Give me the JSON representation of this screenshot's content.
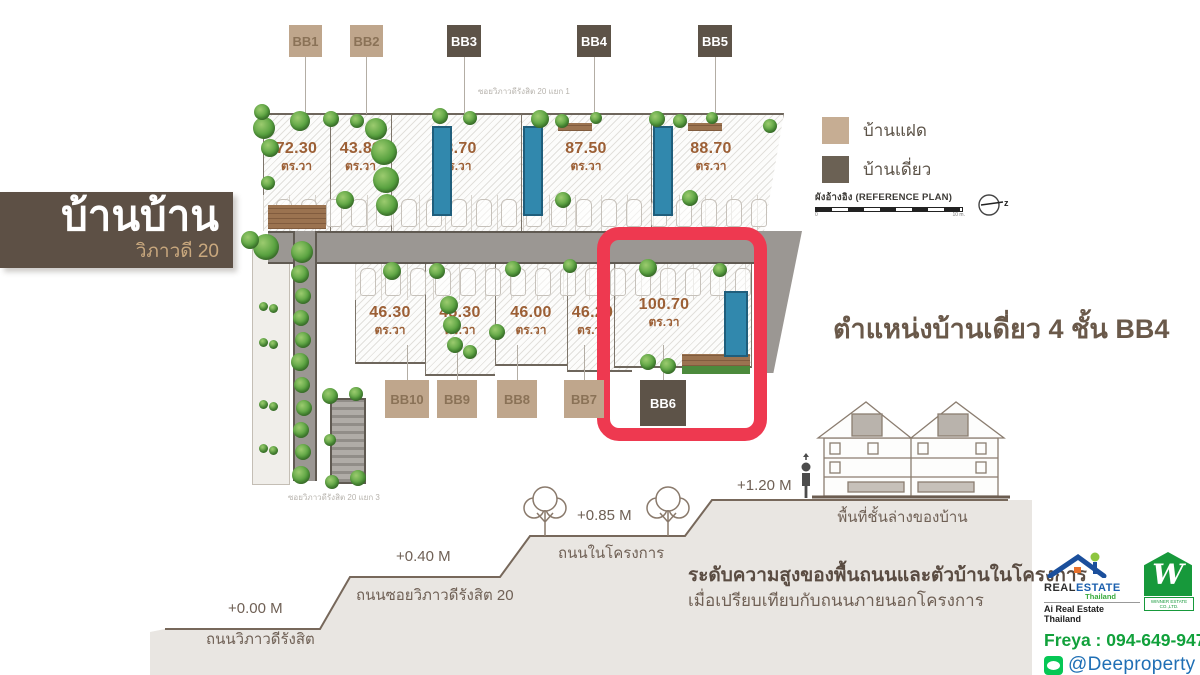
{
  "banner": {
    "title": "บ้านบ้าน",
    "subtitle": "วิภาวดี 20"
  },
  "plan": {
    "street_top": "ซอยวิภาวดีรังสิต 20 แยก 1",
    "street_bottom": "ซอยวิภาวดีรังสิต 20 แยก 3",
    "unit": "ตร.วา",
    "top_labels": [
      "BB1",
      "BB2",
      "BB3",
      "BB4",
      "BB5"
    ],
    "bottom_labels": [
      "BB10",
      "BB9",
      "BB8",
      "BB7",
      "BB6"
    ],
    "top_areas": [
      "72.30",
      "43.89",
      "88.70",
      "87.50",
      "88.70"
    ],
    "bottom_areas": [
      "46.30",
      "45.30",
      "46.00",
      "46.20"
    ],
    "highlight_area": "100.70"
  },
  "legend": {
    "twin": "บ้านแฝด",
    "detached": "บ้านเดี่ยว",
    "reference": "ผังอ้างอิง (REFERENCE PLAN)",
    "scale_start": "0",
    "scale_end": "10 m.",
    "compass_letter": "z"
  },
  "headline": "ตำแหน่งบ้านเดี่ยว 4 ชั้น BB4",
  "elevation": {
    "levels": [
      {
        "height": "+0.00 M",
        "label": "ถนนวิภาวดีรังสิต"
      },
      {
        "height": "+0.40 M",
        "label": "ถนนซอยวิภาวดีรังสิต 20"
      },
      {
        "height": "+0.85 M",
        "label": "ถนนในโครงการ"
      },
      {
        "height": "+1.20 M",
        "label": "พื้นที่ชั้นล่างของบ้าน"
      }
    ],
    "caption_bold": "ระดับความสูงของพื้นถนนและตัวบ้านในโครงการ",
    "caption": "เมื่อเปรียบเทียบกับถนนภายนอกโครงการ"
  },
  "footer": {
    "brand_real": "REAL",
    "brand_estate": "ESTATE",
    "brand_thailand": "Thailand",
    "brand_sub": "Ai Real Estate Thailand",
    "w_letter": "W",
    "w_sub": "WINNER ESTATE CO.,LTD.",
    "phone": "Freya : 094-649-9478",
    "line": "@Deeproperty"
  },
  "colors": {
    "accent_red": "#ee3950",
    "twin_tan": "#bfa68c",
    "detached_brown": "#5d5348",
    "area_text": "#9c5f35",
    "phone_green": "#11a13b",
    "line_blue": "#1f6fb5"
  }
}
